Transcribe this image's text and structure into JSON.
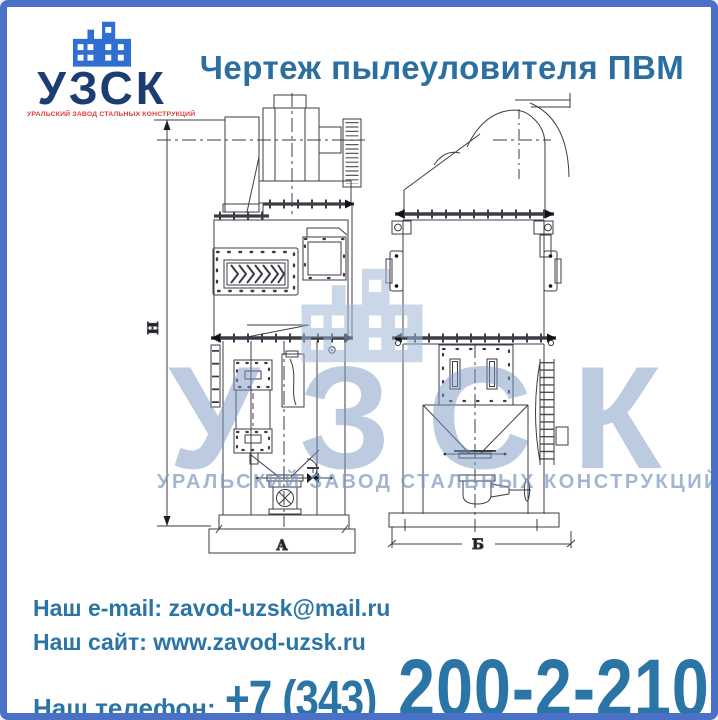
{
  "logo": {
    "name": "УЗСК",
    "tagline": "УРАЛЬСКИЙ ЗАВОД СТАЛЬНЫХ КОНСТРУКЦИЙ"
  },
  "title": "Чертеж пылеуловителя ПВМ",
  "watermark": {
    "name": "УЗСК",
    "tagline": "УРАЛЬСКИЙ ЗАВОД СТАЛЬНЫХ КОНСТРУКЦИЙ"
  },
  "drawing": {
    "dim_height": "Н",
    "dim_width_front": "А",
    "dim_width_side": "Б"
  },
  "contacts": {
    "email_label": "Наш e-mail:",
    "email_value": "zavod-uzsk@mail.ru",
    "site_label": "Наш сайт:",
    "site_value": "www.zavod-uzsk.ru",
    "phone_label": "Наш телефон:",
    "phone_code": "+7 (343)",
    "phone_number": "200-2-210"
  },
  "colors": {
    "accent_blue": "#2b6fa1",
    "border_blue": "#4a71c6",
    "logo_navy": "#1c3d72",
    "logo_icon_blue": "#2f6fd4",
    "logo_red": "#e23a3a",
    "watermark_blue": "#9db8d6"
  }
}
